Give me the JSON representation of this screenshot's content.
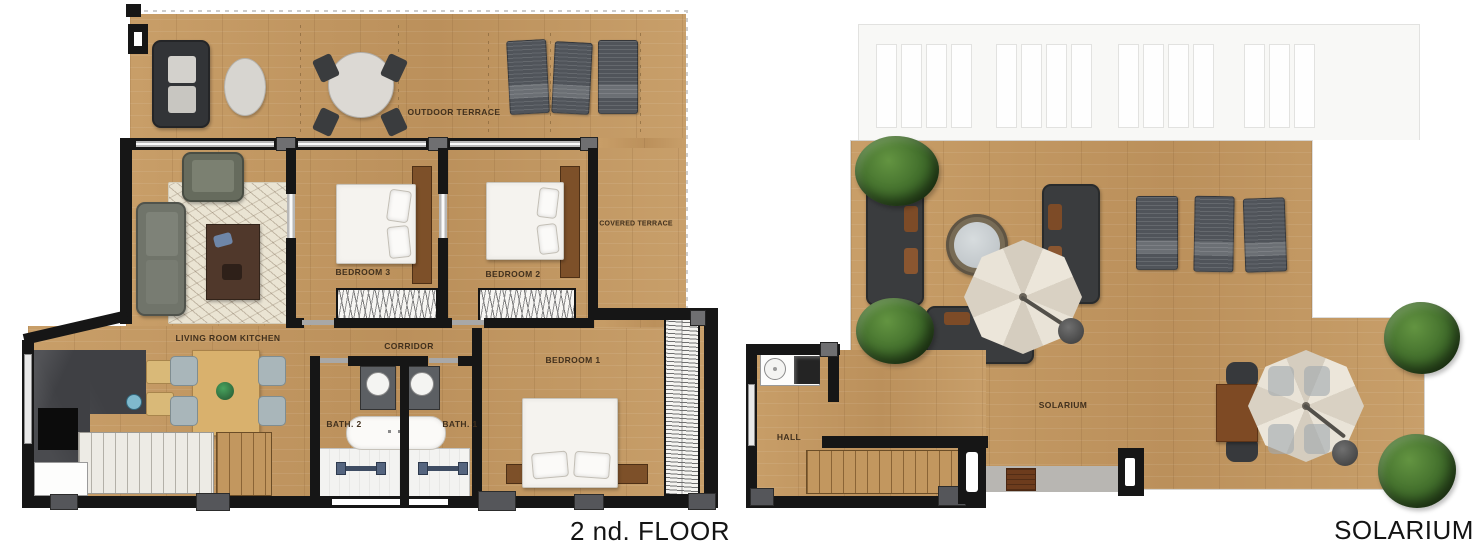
{
  "left_plan": {
    "caption": "2 nd. FLOOR",
    "rooms": {
      "outdoor_terrace": "OUTDOOR TERRACE",
      "covered_terrace": "COVERED TERRACE",
      "bedroom_3": "BEDROOM 3",
      "bedroom_2": "BEDROOM 2",
      "bedroom_1": "BEDROOM 1",
      "living_room_kitchen": "LIVING ROOM KITCHEN",
      "corridor": "CORRIDOR",
      "bath_2": "BATH. 2",
      "bath_1": "BATH. 1"
    }
  },
  "right_plan": {
    "caption": "SOLARIUM",
    "rooms": {
      "solarium": "SOLARIUM",
      "hall": "HALL"
    }
  },
  "colors": {
    "wood": "#c59b65",
    "wall": "#161616",
    "concrete": "#b8b6b2",
    "tree_green": "#3f6b2a",
    "parasol": "#e4ddcf",
    "label_text": "#41301d"
  }
}
